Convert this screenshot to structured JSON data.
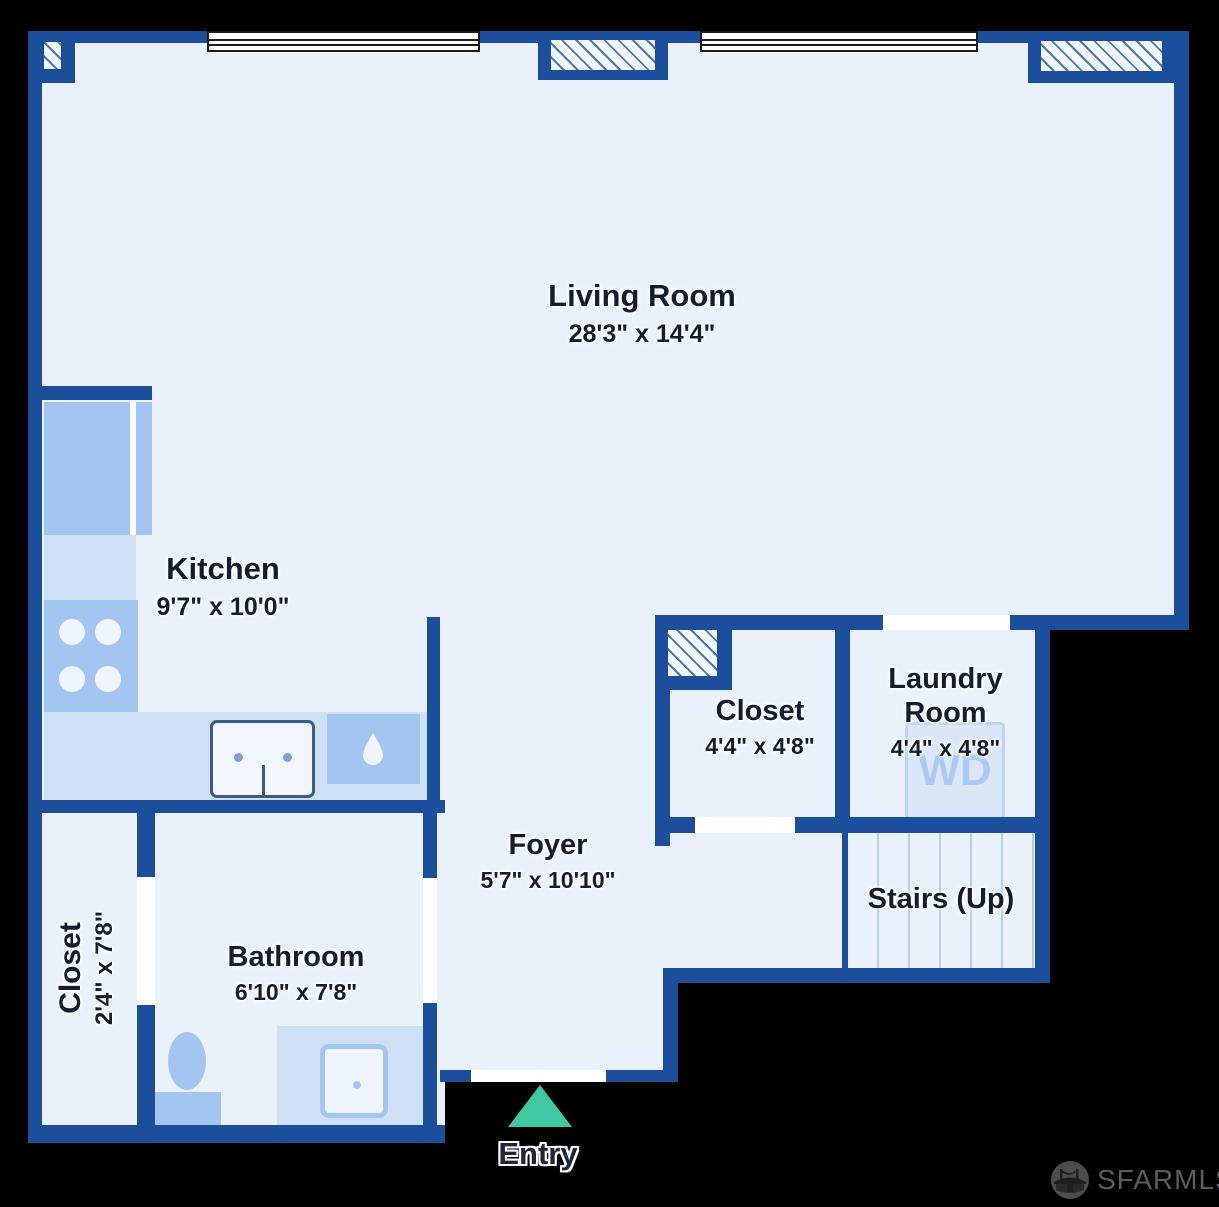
{
  "rooms": {
    "living": {
      "name": "Living Room",
      "dims": "28'3\" x 14'4\""
    },
    "kitchen": {
      "name": "Kitchen",
      "dims": "9'7\" x 10'0\""
    },
    "hall_closet": {
      "name": "Closet",
      "dims": "4'4\" x 4'8\""
    },
    "laundry": {
      "name": "Laundry Room",
      "dims": "4'4\" x 4'8\""
    },
    "foyer": {
      "name": "Foyer",
      "dims": "5'7\" x 10'10\""
    },
    "stairs": {
      "name": "Stairs (Up)"
    },
    "bathroom": {
      "name": "Bathroom",
      "dims": "6'10\" x 7'8\""
    },
    "left_closet": {
      "name": "Closet",
      "dims": "2'4\" x 7'8\""
    }
  },
  "entry": {
    "label": "Entry"
  },
  "appliances": {
    "washer_dryer_label": "WD"
  },
  "watermark": {
    "brand": "SFARMLS"
  },
  "colors": {
    "background": "#000000",
    "wall": "#1b4f9c",
    "floor": "#e9f2fb",
    "fixture": "#a3c6f0",
    "fixture_light": "#cde0f6",
    "tread_line": "#b8cde7",
    "hatch_line": "#4a77b5",
    "window_frame": "#1b1b1b",
    "entry_arrow": "#3fc8a2",
    "label_text": "#141d2e",
    "watermark_text": "#595d60"
  }
}
